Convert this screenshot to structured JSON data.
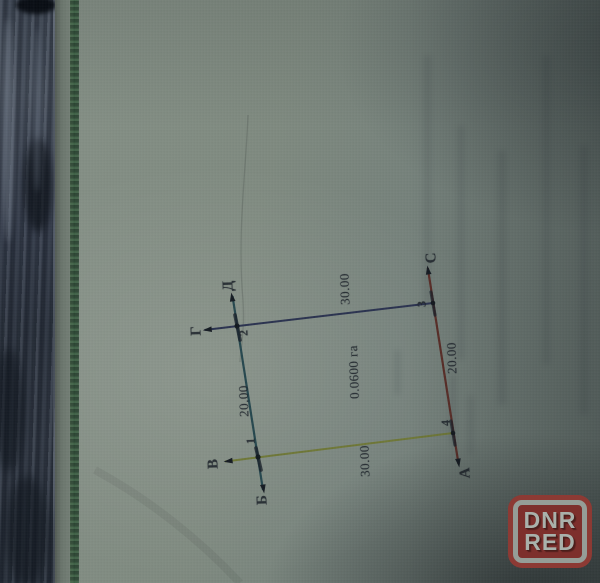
{
  "plan": {
    "area_label": "0.0600 га",
    "corner_numbers": [
      "1",
      "2",
      "3",
      "4"
    ],
    "direction_labels": {
      "a": "А",
      "b": "Б",
      "v": "В",
      "g": "Г",
      "d": "Д",
      "s": "С"
    },
    "side_lengths": {
      "top": "30.00",
      "right": "20.00",
      "bottom": "30.00",
      "left": "20.00"
    },
    "side_colors": {
      "top": "#2b3350",
      "right": "#5a2e28",
      "bottom": "#6f7838",
      "left": "#27484f"
    }
  },
  "watermark": {
    "line1": "DNR",
    "line2": "RED",
    "background": "#7d2f2c",
    "border": "#959d97",
    "text_color": "#a9b1ab"
  }
}
